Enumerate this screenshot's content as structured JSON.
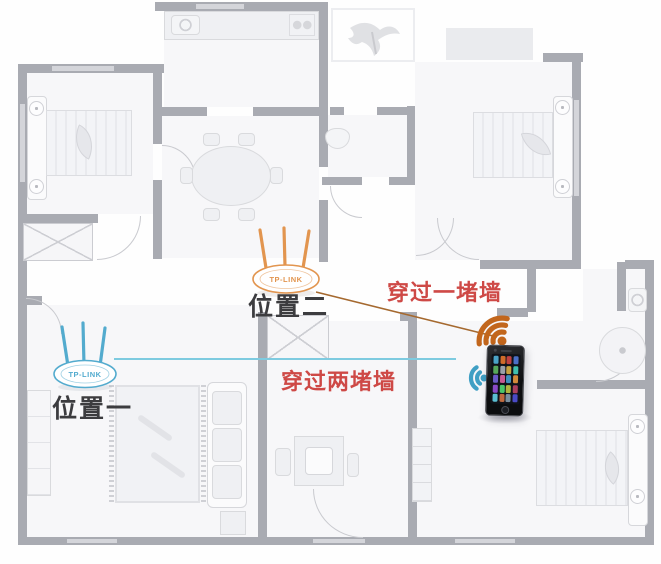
{
  "diagram": {
    "kind": "floor-plan-wifi-router-placement",
    "routers": {
      "position1": {
        "brand": "TP-LINK",
        "label": "位置一"
      },
      "position2": {
        "brand": "TP-LINK",
        "label": "位置二"
      }
    },
    "annotations": {
      "one_wall": "穿过一堵墙",
      "two_walls": "穿过两堵墙"
    },
    "icons": {
      "wifi_orange": "wifi-signal-icon",
      "wifi_blue": "wifi-signal-icon",
      "phone": "smartphone"
    },
    "phone": {
      "app_palette": [
        "#4aa3c7",
        "#cf6b2a",
        "#bf4040",
        "#4a6fc7",
        "#56a85a",
        "#9aa0a8",
        "#c7a23e",
        "#3fbfae",
        "#6a5ac7",
        "#c75a92",
        "#3f8fbf",
        "#d28a3a",
        "#8a4ac7",
        "#4ac76a",
        "#b0b43f",
        "#aa3f5f",
        "#5abfd2",
        "#bf6a3f",
        "#7a8f9f",
        "#4a4ac7"
      ]
    },
    "colors": {
      "wall": "#a9abb2",
      "wall_light": "#d4d5da",
      "router_blue": "#53abce",
      "router_orange": "#e2954f",
      "signal_line_blue": "#7ecbe0",
      "signal_line_orange": "#a5692f",
      "wifi_blue": "#3f9fc4",
      "wifi_orange": "#c2661c",
      "annotation_red": "#ce4946"
    }
  }
}
